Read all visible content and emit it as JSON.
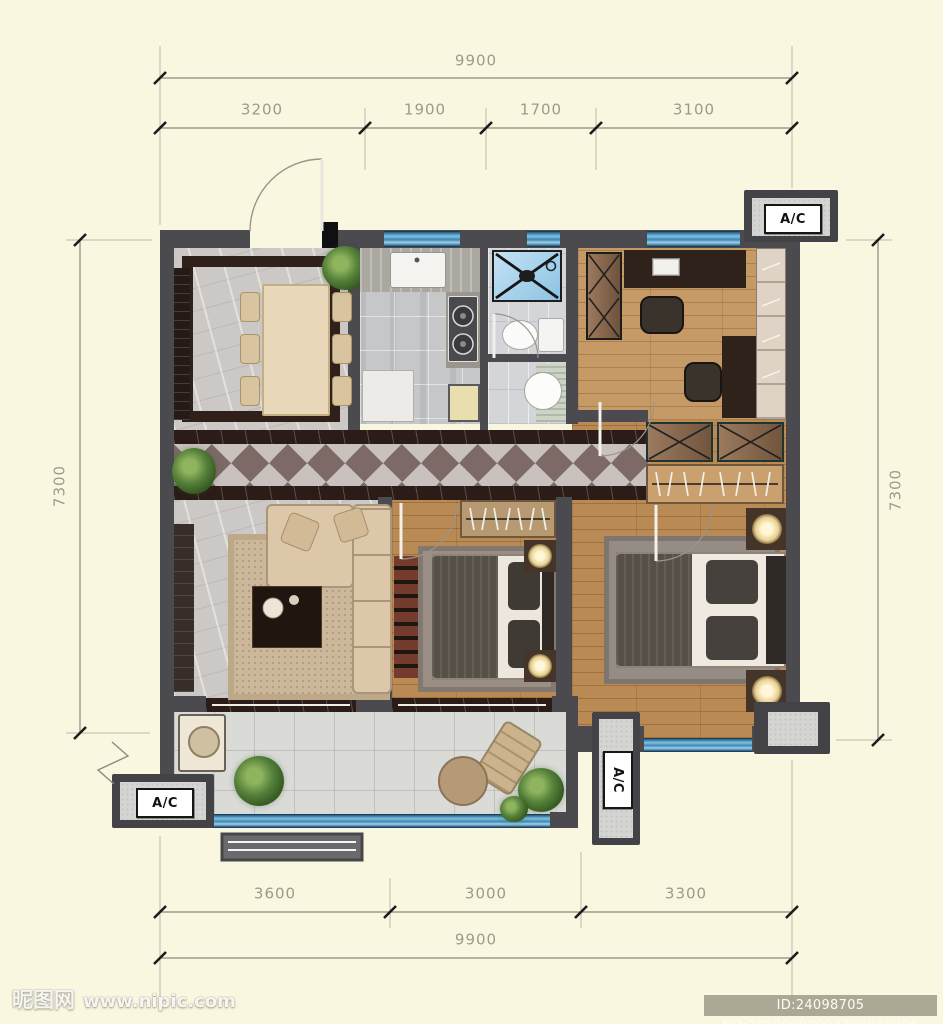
{
  "dimensions": {
    "top": {
      "total": "9900",
      "segments": [
        "3200",
        "1900",
        "1700",
        "3100"
      ]
    },
    "bottom": {
      "total": "9900",
      "segments": [
        "3600",
        "3000",
        "3300"
      ]
    },
    "left": "7300",
    "right": "7300"
  },
  "ac_units": {
    "top_right": "A/C",
    "bottom_left": "A/C",
    "balcony_mid": "A/C"
  },
  "watermark": {
    "logo_text": "昵图网",
    "site_url": "www.nipic.com"
  },
  "footer_id": "ID:24098705 NO:20200908094759950086",
  "colors": {
    "background": "#faf7e1",
    "wall": "#4a4a4f",
    "window_blue": "#3f86b5",
    "wood_floor": "#c59a66",
    "marble_floor": "#ccc8c5",
    "dark_border_tile": "#2b1c18",
    "dimension_text": "#9d998c",
    "id_bar_bg": "#9e9a88"
  }
}
